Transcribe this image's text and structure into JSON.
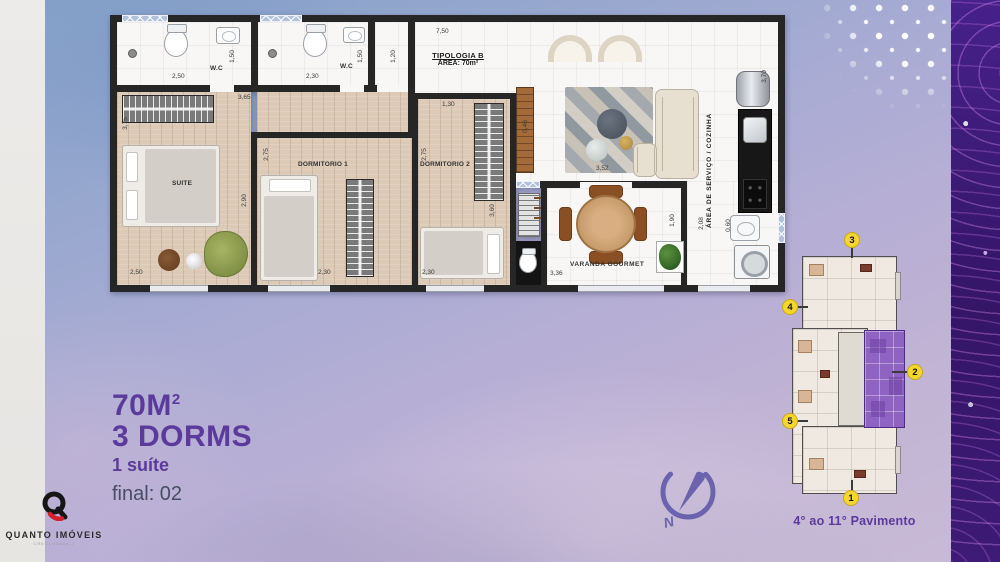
{
  "headline": {
    "area_value": "70M",
    "area_exponent": "2",
    "dorms": "3 DORMS",
    "suite": "1 suíte",
    "final": "final: 02"
  },
  "logo": {
    "name": "QUANTO IMÓVEIS",
    "subtitle": "CRECI 23884-J"
  },
  "compass": {
    "label": "N"
  },
  "plan": {
    "typology_title": "TIPOLOGIA B",
    "typology_area": "ÁREA: 70m²",
    "rooms": {
      "suite": "SUITE",
      "dorm1": "DORMITORIO 1",
      "dorm2": "DORMITORIO 2",
      "wc1": "W.C",
      "wc2": "W.C",
      "varanda": "VARANDA GOURMET",
      "service": "ÁREA DE SERVIÇO / COZINHA"
    },
    "dimensions": [
      {
        "t": "2,50",
        "x": 62,
        "y": 58
      },
      {
        "t": "1,50",
        "x": 116,
        "y": 38,
        "r": 1
      },
      {
        "t": "2,30",
        "x": 196,
        "y": 58
      },
      {
        "t": "1,50",
        "x": 244,
        "y": 38,
        "r": 1
      },
      {
        "t": "1,20",
        "x": 277,
        "y": 38,
        "r": 1
      },
      {
        "t": "7,50",
        "x": 326,
        "y": 13
      },
      {
        "t": "3,65",
        "x": 128,
        "y": 79
      },
      {
        "t": "3,75",
        "x": 9,
        "y": 105,
        "r": 1
      },
      {
        "t": "2,90",
        "x": 128,
        "y": 182,
        "r": 1
      },
      {
        "t": "2,50",
        "x": 20,
        "y": 254
      },
      {
        "t": "2,75",
        "x": 150,
        "y": 136,
        "r": 1
      },
      {
        "t": "2,30",
        "x": 208,
        "y": 254
      },
      {
        "t": "2,75",
        "x": 308,
        "y": 136,
        "r": 1
      },
      {
        "t": "1,30",
        "x": 332,
        "y": 86
      },
      {
        "t": "3,60",
        "x": 376,
        "y": 192,
        "r": 1
      },
      {
        "t": "2,30",
        "x": 312,
        "y": 254
      },
      {
        "t": "0,46",
        "x": 409,
        "y": 108,
        "r": 1
      },
      {
        "t": "3,52",
        "x": 486,
        "y": 150
      },
      {
        "t": "3,36",
        "x": 440,
        "y": 255
      },
      {
        "t": "1,90",
        "x": 556,
        "y": 202,
        "r": 1
      },
      {
        "t": "2,08",
        "x": 585,
        "y": 205,
        "r": 1
      },
      {
        "t": "0,60",
        "x": 612,
        "y": 207,
        "r": 1
      },
      {
        "t": "3,70",
        "x": 648,
        "y": 58,
        "r": 1
      }
    ]
  },
  "keyplan": {
    "caption": "4° ao 11° Pavimento",
    "units": [
      {
        "n": "3",
        "x": 62,
        "y": 2
      },
      {
        "n": "4",
        "x": 0,
        "y": 69
      },
      {
        "n": "2",
        "x": 125,
        "y": 134
      },
      {
        "n": "5",
        "x": 0,
        "y": 183
      },
      {
        "n": "1",
        "x": 61,
        "y": 260
      }
    ]
  },
  "colors": {
    "accent_purple": "#5b3a9b",
    "badge_yellow": "#f5d62e",
    "unit_highlight": "#8f63c2",
    "wall": "#262626"
  }
}
